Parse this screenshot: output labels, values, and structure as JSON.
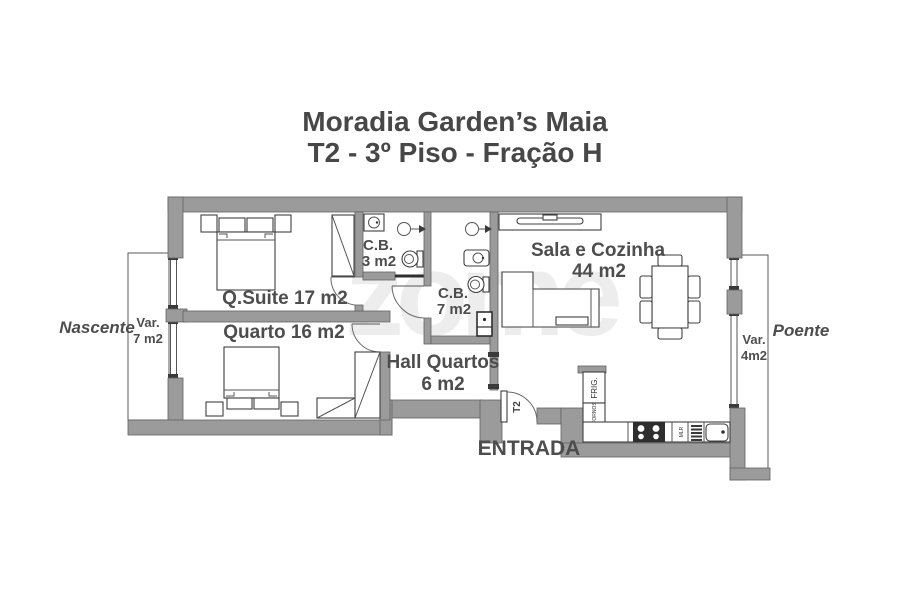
{
  "title": {
    "line1": "Moradia Garden’s Maia",
    "line2": "T2 - 3º Piso - Fração H"
  },
  "orientation": {
    "left": "Nascente",
    "right": "Poente"
  },
  "rooms": {
    "suite": "Q.Suite 17 m2",
    "bedroom": "Quarto 16 m2",
    "living_line1": "Sala e Cozinha",
    "living_line2": "44 m2",
    "bath_small_line1": "C.B.",
    "bath_small_line2": "3 m2",
    "bath_main_line1": "C.B.",
    "bath_main_line2": "7 m2",
    "hall_line1": "Hall Quartos",
    "hall_line2": "6 m2",
    "balcony_left_line1": "Var.",
    "balcony_left_line2": "7 m2",
    "balcony_right_line1": "Var.",
    "balcony_right_line2": "4m2"
  },
  "entrance": {
    "label": "ENTRADA",
    "door": "T2"
  },
  "kitchen": {
    "fridge": "FRIG.",
    "ovens": "FORNOS",
    "washer": "MLR"
  },
  "watermark": "zome",
  "colors": {
    "wall": "#9b9b9b",
    "outline": "#636363",
    "text": "#4d4d4d",
    "title": "#474747",
    "watermark": "#ededed",
    "background": "#ffffff"
  }
}
